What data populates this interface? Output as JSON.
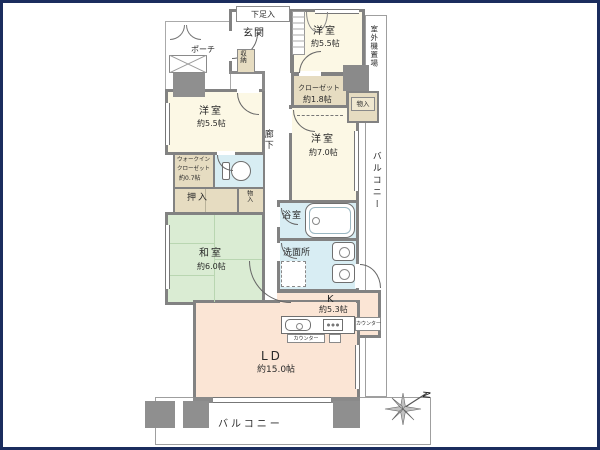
{
  "rooms": {
    "entrance": {
      "label": "玄関"
    },
    "shoe_box": {
      "label": "下足入"
    },
    "porch": {
      "label": "ポーチ"
    },
    "storage_genkan": {
      "label": "収納"
    },
    "bedroom_top": {
      "name": "洋室",
      "size": "約5.5帖"
    },
    "outdoor_unit": {
      "label": "室外機置場"
    },
    "closet_18": {
      "name": "クローゼット",
      "size": "約1.8帖"
    },
    "storage_right": {
      "label": "物入"
    },
    "bedroom_left": {
      "name": "洋室",
      "size": "約5.5帖"
    },
    "hallway": {
      "label": "廊下"
    },
    "bedroom_mid": {
      "name": "洋室",
      "size": "約7.0帖"
    },
    "balcony_right": {
      "label": "バルコニー"
    },
    "wic": {
      "line1": "ウォークイン",
      "line2": "クローゼット",
      "line3": "約0.7帖"
    },
    "oshiire": {
      "label": "押入"
    },
    "storage_small": {
      "label": "物入"
    },
    "washitsu": {
      "name": "和室",
      "size": "約6.0帖"
    },
    "bathroom": {
      "label": "浴室"
    },
    "washroom": {
      "label": "洗面所"
    },
    "kitchen": {
      "name": "K",
      "size": "約5.3帖"
    },
    "counter1": {
      "label": "カウンター"
    },
    "counter2": {
      "label": "カウンター"
    },
    "living": {
      "name": "LD",
      "size": "約15.0帖"
    },
    "balcony_bottom": {
      "label": "バルコニー"
    }
  },
  "compass": {
    "label": "N"
  },
  "colors": {
    "frame": "#1b2d5e",
    "wall": "#8a8a8a",
    "western_room": "#fcf8e5",
    "closet": "#e6dcc1",
    "tatami_room": "#daecd3",
    "wet_area": "#d8edf3",
    "living_kitchen": "#fbe5d5"
  }
}
